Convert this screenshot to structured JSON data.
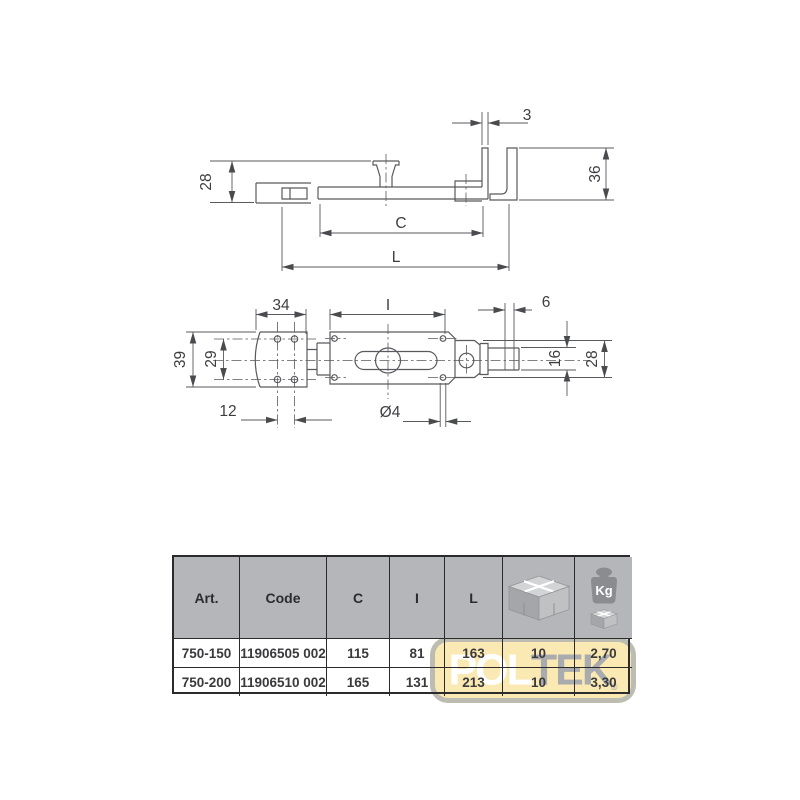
{
  "side_view": {
    "labels": {
      "d3": "3",
      "d28": "28",
      "d36": "36",
      "dC": "C",
      "dL": "L"
    }
  },
  "top_view": {
    "labels": {
      "d34": "34",
      "dI": "I",
      "d6": "6",
      "d39": "39",
      "d29": "29",
      "d16": "16",
      "d28": "28",
      "d12": "12",
      "d4": "Ø4"
    }
  },
  "table": {
    "headers": {
      "art": "Art.",
      "code": "Code",
      "c": "C",
      "i": "I",
      "l": "L"
    },
    "icons": {
      "package": "carton-box-icon",
      "weight": "kg-weight-icon",
      "weight_label": "Kg"
    },
    "rows": [
      {
        "art": "750-150",
        "code": "11906505 002",
        "c": "115",
        "i": "81",
        "l": "163",
        "pack": "10",
        "kg": "2,70"
      },
      {
        "art": "750-200",
        "code": "11906510 002",
        "c": "165",
        "i": "131",
        "l": "213",
        "pack": "10",
        "kg": "3,30"
      }
    ]
  },
  "watermark": {
    "part1": "POL",
    "part2": "TEK",
    "reg": "®"
  },
  "colors": {
    "header_bg": "#b4b6b9",
    "line": "#2b2b2e",
    "drawing_line": "#595a5e",
    "drawing_text": "#3d3e41",
    "watermark_bg": "#fae9b2",
    "watermark_text_light": "#ffffff",
    "watermark_text_gray": "#a9abae"
  }
}
